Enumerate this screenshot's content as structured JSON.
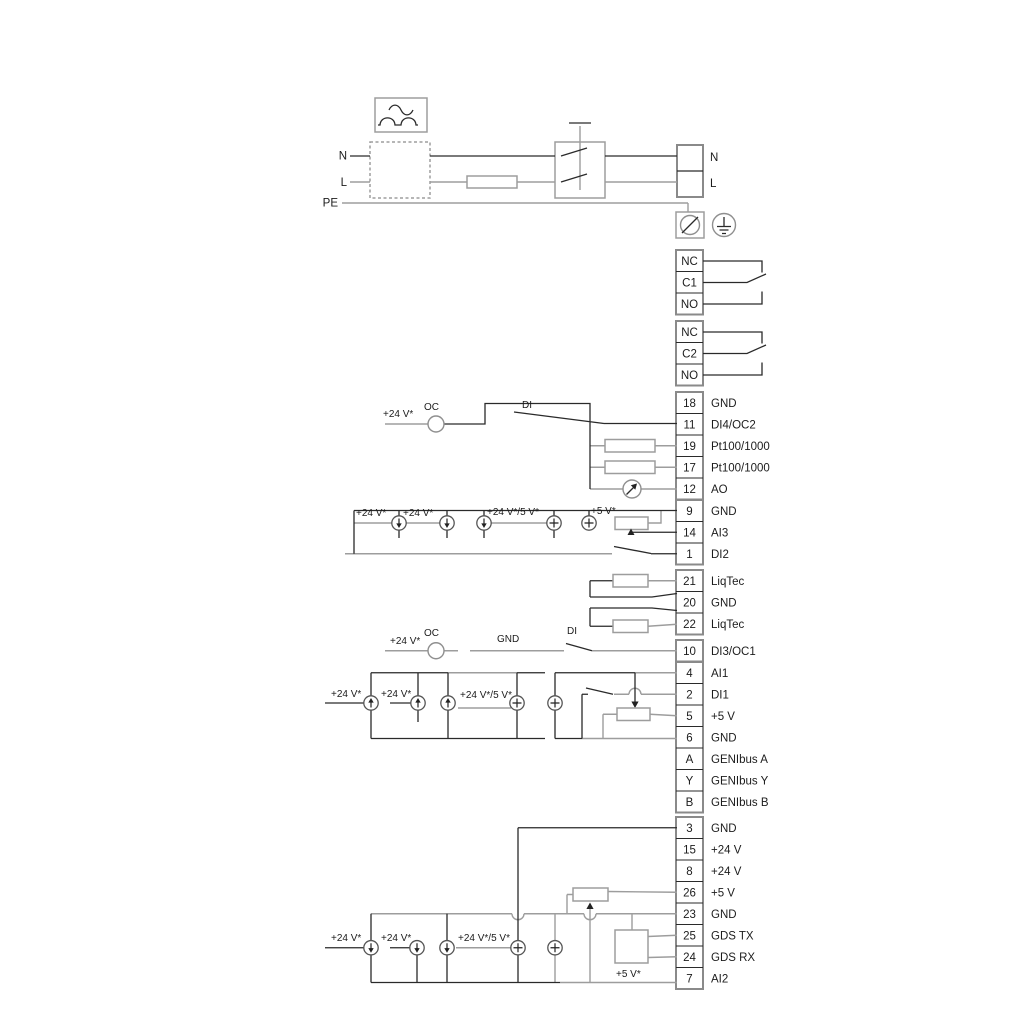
{
  "diagram": {
    "power": {
      "n_in": "N",
      "l_in": "L",
      "pe": "PE",
      "n_out": "N",
      "l_out": "L"
    },
    "relays": [
      {
        "rows": [
          "NC",
          "C1",
          "NO"
        ]
      },
      {
        "rows": [
          "NC",
          "C2",
          "NO"
        ]
      }
    ],
    "labels": {
      "plus24": "+24 V*",
      "plus24_5": "+24 V*/5 V*",
      "plus5": "+5 V*",
      "oc": "OC",
      "di": "DI",
      "gnd": "GND"
    },
    "terminals": [
      {
        "n": "18",
        "t": "GND"
      },
      {
        "n": "11",
        "t": "DI4/OC2"
      },
      {
        "n": "19",
        "t": "Pt100/1000"
      },
      {
        "n": "17",
        "t": "Pt100/1000"
      },
      {
        "n": "12",
        "t": "AO"
      },
      {
        "n": "9",
        "t": "GND"
      },
      {
        "n": "14",
        "t": "AI3"
      },
      {
        "n": "1",
        "t": "DI2"
      },
      {
        "n": "21",
        "t": "LiqTec"
      },
      {
        "n": "20",
        "t": "GND"
      },
      {
        "n": "22",
        "t": "LiqTec"
      },
      {
        "n": "10",
        "t": "DI3/OC1"
      },
      {
        "n": "4",
        "t": "AI1"
      },
      {
        "n": "2",
        "t": "DI1"
      },
      {
        "n": "5",
        "t": "+5 V"
      },
      {
        "n": "6",
        "t": "GND"
      },
      {
        "n": "A",
        "t": "GENIbus A"
      },
      {
        "n": "Y",
        "t": "GENIbus Y"
      },
      {
        "n": "B",
        "t": "GENIbus B"
      },
      {
        "n": "3",
        "t": "GND"
      },
      {
        "n": "15",
        "t": "+24 V"
      },
      {
        "n": "8",
        "t": "+24 V"
      },
      {
        "n": "26",
        "t": "+5 V"
      },
      {
        "n": "23",
        "t": "GND"
      },
      {
        "n": "25",
        "t": "GDS TX"
      },
      {
        "n": "24",
        "t": "GDS RX"
      },
      {
        "n": "7",
        "t": "AI2"
      }
    ]
  }
}
